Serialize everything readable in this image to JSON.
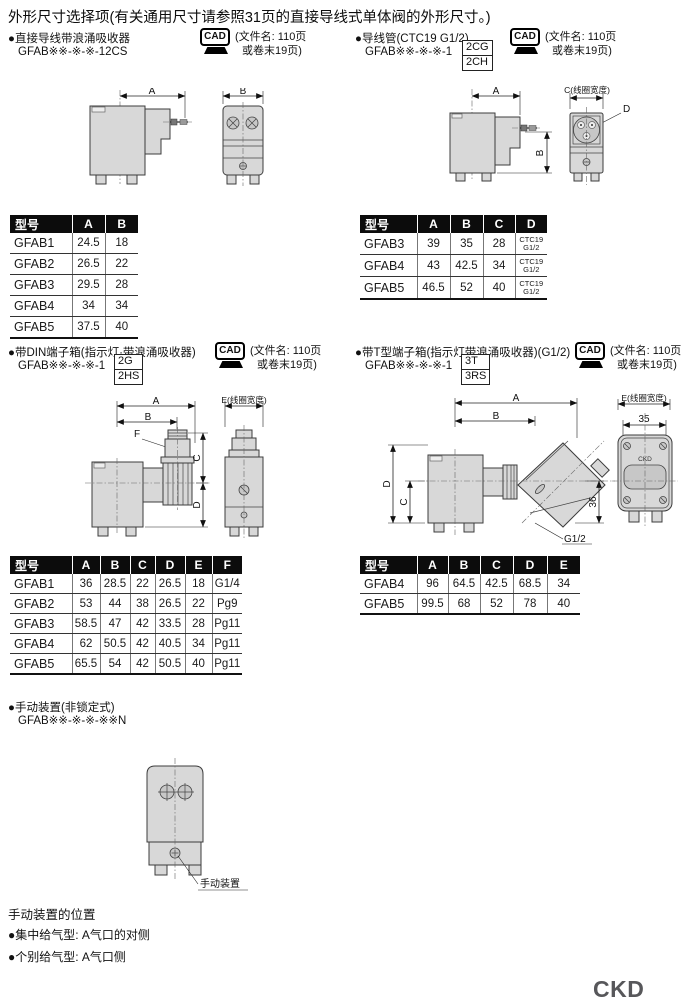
{
  "page": {
    "title": "外形尺寸选择项(有关通用尺寸请参照31页的直接导线式单体阀的外形尺寸。)",
    "brand": "CKD"
  },
  "cad_note": {
    "label": "CAD",
    "line1": "(文件名: 110页",
    "line2": "或卷末19页)"
  },
  "sections": {
    "direct_lead": {
      "title": "●直接导线带浪涌吸收器",
      "model": "GFAB※※-※-※-12CS"
    },
    "conduit": {
      "title": "●导线管(CTC19 G1/2)",
      "model_prefix": "GFAB※※-※-※-1",
      "opt1": "2CG",
      "opt2": "2CH"
    },
    "din": {
      "title": "●带DIN端子箱(指示灯·带浪涌吸收器)",
      "model_prefix": "GFAB※※-※-※-1",
      "opt1": "2G",
      "opt2": "2HS"
    },
    "t_box": {
      "title": "●带T型端子箱(指示灯带浪涌吸收器)(G1/2)",
      "model_prefix": "GFAB※※-※-※-1",
      "opt1": "3T",
      "opt2": "3RS"
    },
    "manual": {
      "title": "●手动装置(非锁定式)",
      "model": "GFAB※※-※-※-※※N"
    }
  },
  "tables": {
    "direct_lead": {
      "h": [
        "型号",
        "A",
        "B"
      ],
      "rows": [
        [
          "GFAB1",
          "24.5",
          "18"
        ],
        [
          "GFAB2",
          "26.5",
          "22"
        ],
        [
          "GFAB3",
          "29.5",
          "28"
        ],
        [
          "GFAB4",
          "34",
          "34"
        ],
        [
          "GFAB5",
          "37.5",
          "40"
        ]
      ]
    },
    "conduit": {
      "h": [
        "型号",
        "A",
        "B",
        "C",
        "D"
      ],
      "d_top": "CTC19",
      "d_bottom": "G1/2",
      "rows": [
        [
          "GFAB3",
          "39",
          "35",
          "28"
        ],
        [
          "GFAB4",
          "43",
          "42.5",
          "34"
        ],
        [
          "GFAB5",
          "46.5",
          "52",
          "40"
        ]
      ]
    },
    "din": {
      "h": [
        "型号",
        "A",
        "B",
        "C",
        "D",
        "E",
        "F"
      ],
      "rows": [
        [
          "GFAB1",
          "36",
          "28.5",
          "22",
          "26.5",
          "18",
          "G1/4"
        ],
        [
          "GFAB2",
          "53",
          "44",
          "38",
          "26.5",
          "22",
          "Pg9"
        ],
        [
          "GFAB3",
          "58.5",
          "47",
          "42",
          "33.5",
          "28",
          "Pg11"
        ],
        [
          "GFAB4",
          "62",
          "50.5",
          "42",
          "40.5",
          "34",
          "Pg11"
        ],
        [
          "GFAB5",
          "65.5",
          "54",
          "42",
          "50.5",
          "40",
          "Pg11"
        ]
      ]
    },
    "t_box": {
      "h": [
        "型号",
        "A",
        "B",
        "C",
        "D",
        "E"
      ],
      "rows": [
        [
          "GFAB4",
          "96",
          "64.5",
          "42.5",
          "68.5",
          "34"
        ],
        [
          "GFAB5",
          "99.5",
          "68",
          "52",
          "78",
          "40"
        ]
      ]
    }
  },
  "drawings": {
    "d1": {
      "dimA": "A",
      "dimB": "B"
    },
    "d2": {
      "dimA": "A",
      "dimB": "B",
      "dimC": "C(线圈宽度)",
      "dimD": "D"
    },
    "d3": {
      "dimA": "A",
      "dimB": "B",
      "dimC": "C",
      "dimD": "D",
      "dimE": "E(线圈宽度)",
      "dimF": "F"
    },
    "d4": {
      "dimA": "A",
      "dimB": "B",
      "dimC": "C",
      "dimD": "D",
      "dimE": "E(线圈宽度)",
      "dim35": "35",
      "dim36": "36",
      "thread": "G1/2",
      "body_text": "CKD"
    },
    "d5": {
      "label": "手动装置"
    }
  },
  "manual_position": {
    "title": "手动装置的位置",
    "line1": "●集中给气型: A气口的对侧",
    "line2": "●个别给气型: A气口侧"
  }
}
